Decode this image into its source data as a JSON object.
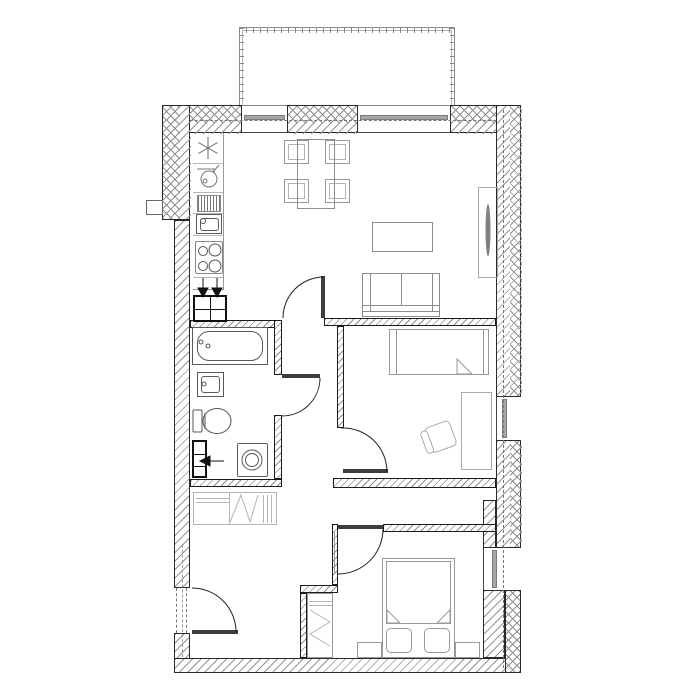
{
  "document": {
    "kind": "architectural-floor-plan",
    "style": "monochrome CAD drawing, top view, no text labels",
    "canvas": {
      "width": 700,
      "height": 700
    }
  },
  "colors": {
    "background": "#ffffff",
    "wall_outline": "#2a2a2a",
    "wall_hatch": "#8f8f8f",
    "fixture_stroke": "#5a5a5a",
    "light_furniture_stroke": "#9e9e9e",
    "door_leaf": "#3d3d3d",
    "glazing_bar": "#a6a6a6",
    "axis_dash": "#777777",
    "arrow_fill": "#111111"
  },
  "rooms": [
    {
      "id": "balcony",
      "name": "balcony",
      "features": [
        "railing-with-posts"
      ]
    },
    {
      "id": "kitchen-living",
      "name": "open kitchen and living room",
      "fixtures": [
        "kitchen-counter",
        "light-symbol",
        "hood-symbol",
        "dish-drainer",
        "kitchen-sink",
        "cooktop-4-burners",
        "ventilation-shaft-2-arrows",
        "dining-table",
        "chair x4",
        "coffee-table",
        "sofa",
        "tv-unit"
      ]
    },
    {
      "id": "bathroom",
      "name": "bathroom",
      "fixtures": [
        "bathtub",
        "washbasin",
        "toilet",
        "washing-machine",
        "plumbing-shaft-1-arrow"
      ]
    },
    {
      "id": "bedroom-middle",
      "name": "middle bedroom",
      "fixtures": [
        "single-bed",
        "desk",
        "swivel-chair"
      ]
    },
    {
      "id": "bedroom-bottom",
      "name": "bottom bedroom",
      "fixtures": [
        "double-bed",
        "pillow x2",
        "nightstand x2",
        "built-in-wardrobe"
      ]
    },
    {
      "id": "hallway",
      "name": "hallway",
      "fixtures": [
        "built-in-wardrobe"
      ]
    }
  ],
  "openings": {
    "windows_top_wall": 2,
    "windows_right_wall": 2,
    "interior_doors": 4,
    "entry_door_left_wall": 1,
    "door_swing_arcs": 5
  },
  "annotations": {
    "wall_axis_lines": "dash-dot center lines through top and right exterior walls and entry wall",
    "exterior_wall_layers": "outer cross-hatched insulation + inner diagonal-hatched masonry",
    "ventilation_arrows": 3
  }
}
